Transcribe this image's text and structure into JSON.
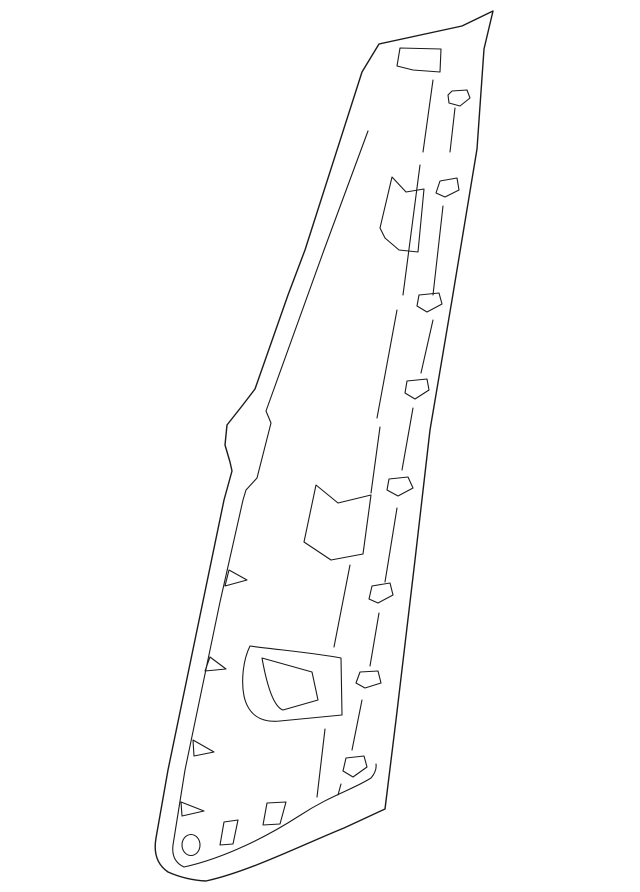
{
  "canvas": {
    "width": 640,
    "height": 892,
    "background": "#ffffff",
    "stroke_color": "#1a1a1a",
    "stroke_width": 1.1
  },
  "diagram": {
    "kind": "auto-part-line-drawing",
    "shapes": [
      {
        "name": "part-outline",
        "type": "path",
        "stroke_width": 1.4,
        "d": "M493,11 L462,26 L379,44 L362,72 L305,250 L288,295 L255,389 L242,406 L227,425 L225,445 L230,462 L232,471 L224,500 L168,770 L156,838 Q152,861 168,872 Q186,880 206,881 C248,872 302,845 344,828 L385,809 L396,720 L415,560 L430,430 L452,300 L477,149 L484,49 Z"
      },
      {
        "name": "inner-edge-crease",
        "type": "path",
        "d": "M368,131 L324,250 L266,411 L271,423 L257,478 L246,490 L243,500 L220,602 L185,770 L173,845 Q171,861 184,867 C225,858 268,836 299,816 C331,795 352,790 371,778 Q377,771 376,764"
      },
      {
        "name": "window-hole-top",
        "type": "path",
        "d": "M400,48 L441,49 L440,72 L413,70 L397,66 Z"
      },
      {
        "name": "fold-tab-upper",
        "type": "path",
        "d": "M392,177 L406,192 L424,189 L418,252 L399,250 L385,238 L380,228 Z"
      },
      {
        "name": "fold-tab-middle",
        "type": "path",
        "d": "M316,485 L338,503 L371,495 L363,554 L331,560 L304,542 Z"
      },
      {
        "name": "handle-cup-outer",
        "type": "path",
        "d": "M250,646 C280,650 315,653 341,658 L342,715 L280,721 C260,723 248,714 244,696 C241,681 243,660 250,646 Z"
      },
      {
        "name": "handle-cup-inner",
        "type": "path",
        "d": "M262,658 L312,672 L318,700 L283,710 C274,707 267,686 262,658 Z"
      },
      {
        "name": "clip-boss-1",
        "type": "path",
        "d": "M452,91 L467,90 L470,98 L460,106 L449,103 L448,95 Z"
      },
      {
        "name": "clip-boss-2",
        "type": "path",
        "d": "M440,181 L457,178 L459,190 L445,197 L436,193 Z"
      },
      {
        "name": "clip-boss-3",
        "type": "path",
        "d": "M419,295 L439,293 L442,304 L427,312 L417,306 Z"
      },
      {
        "name": "clip-boss-4",
        "type": "path",
        "d": "M407,381 L427,379 L429,390 L415,399 L405,393 Z"
      },
      {
        "name": "clip-boss-5",
        "type": "path",
        "d": "M389,479 L408,477 L413,488 L398,496 L387,490 Z"
      },
      {
        "name": "clip-boss-6",
        "type": "path",
        "d": "M372,586 L390,583 L393,595 L378,603 L369,599 Z"
      },
      {
        "name": "clip-boss-7",
        "type": "path",
        "d": "M360,672 L378,671 L381,683 L365,688 L356,683 Z"
      },
      {
        "name": "clip-boss-8",
        "type": "path",
        "d": "M346,758 L364,756 L367,767 L353,777 L343,771 Z"
      },
      {
        "name": "rib-line-a1",
        "type": "path",
        "d": "M433,80 L423,152"
      },
      {
        "name": "rib-line-a2",
        "type": "path",
        "d": "M420,165 L403,295"
      },
      {
        "name": "rib-line-a3",
        "type": "path",
        "d": "M397,310 L377,418"
      },
      {
        "name": "rib-line-a4",
        "type": "path",
        "d": "M380,427 L371,493"
      },
      {
        "name": "rib-line-a5",
        "type": "path",
        "d": "M350,565 L334,647"
      },
      {
        "name": "rib-line-a6",
        "type": "path",
        "d": "M325,729 L317,797"
      },
      {
        "name": "rib-line-b1",
        "type": "path",
        "d": "M455,108 L450,152"
      },
      {
        "name": "rib-line-b2",
        "type": "path",
        "d": "M443,206 L433,295"
      },
      {
        "name": "rib-line-b3",
        "type": "path",
        "d": "M433,320 L421,373"
      },
      {
        "name": "rib-line-b4",
        "type": "path",
        "d": "M413,408 L402,470"
      },
      {
        "name": "rib-line-b5",
        "type": "path",
        "d": "M397,508 L385,582"
      },
      {
        "name": "rib-line-b6",
        "type": "path",
        "d": "M379,613 L370,666"
      },
      {
        "name": "rib-line-b7",
        "type": "path",
        "d": "M362,700 L352,750"
      },
      {
        "name": "rib-line-b8",
        "type": "path",
        "d": "M341,784 L338,795"
      },
      {
        "name": "edge-notch-1",
        "type": "path",
        "d": "M229,570 L247,580 L225,586 Z"
      },
      {
        "name": "edge-notch-2",
        "type": "path",
        "d": "M210,657 L226,669 L205,671 Z"
      },
      {
        "name": "edge-notch-3",
        "type": "path",
        "d": "M193,740 L214,752 L194,756 Z"
      },
      {
        "name": "edge-notch-4",
        "type": "path",
        "d": "M181,802 L204,811 L182,816 Z"
      },
      {
        "name": "grommet-hole",
        "type": "ellipse",
        "cx": 191,
        "cy": 845,
        "rx": 9,
        "ry": 10.5
      },
      {
        "name": "slot-hole-1",
        "type": "path",
        "d": "M220,845 L224,822 L238,820 L233,844 Z"
      },
      {
        "name": "slot-hole-2",
        "type": "path",
        "d": "M263,825 L267,803 L286,802 L280,824 Z"
      }
    ]
  }
}
